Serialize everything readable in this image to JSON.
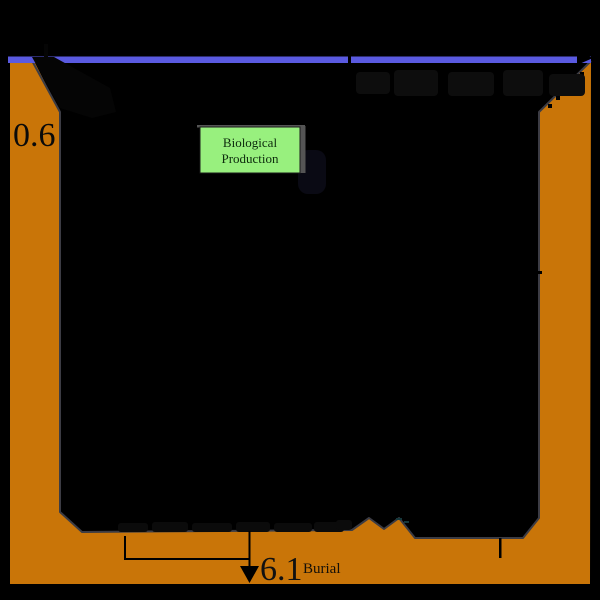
{
  "figure": {
    "title": "ocean-basin-flux-diagram",
    "labels": {
      "left_flux_value": "0.6",
      "burial_value": "6.1",
      "burial_label": "Burial",
      "bio_box_line1": "Biological",
      "bio_box_line2": "Production"
    },
    "colors": {
      "background": "#000000",
      "surface_line": "#5a5ae0",
      "sediment": "#c97508",
      "inner_outline": "#3c3c44",
      "bio_box_fill": "#98f07e",
      "bio_box_shadow": "#555555",
      "arrow_black": "#000000"
    }
  }
}
